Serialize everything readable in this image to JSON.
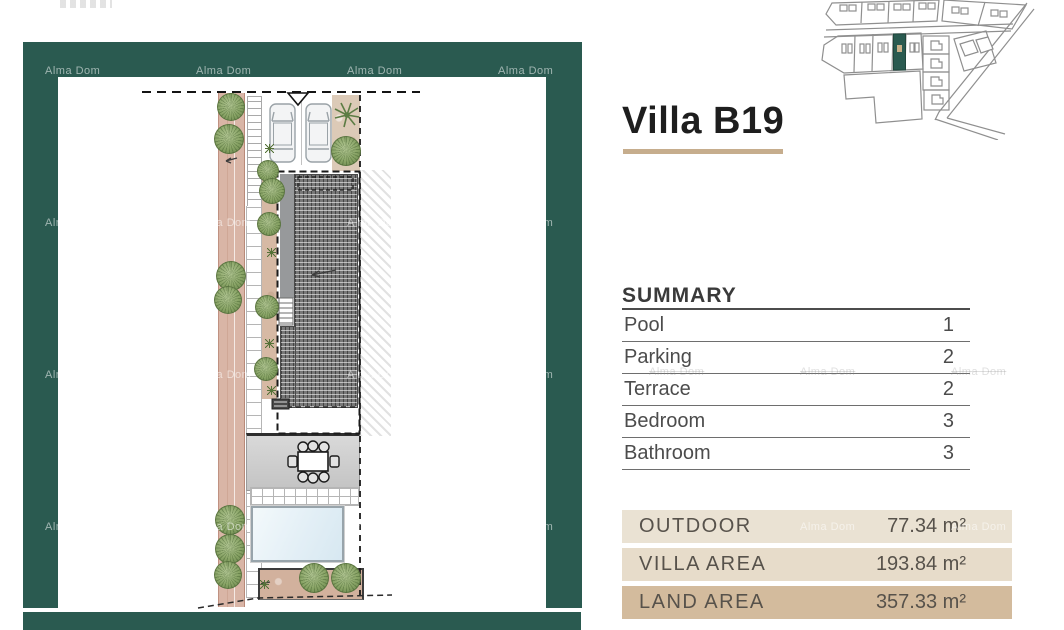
{
  "watermark_text": "Alma Dom",
  "panel": {
    "title": "Villa B19",
    "summary_heading": "SUMMARY",
    "summary_rows": [
      {
        "label": "Pool",
        "value": "1"
      },
      {
        "label": "Parking",
        "value": "2"
      },
      {
        "label": "Terrace",
        "value": "2"
      },
      {
        "label": "Bedroom",
        "value": "3"
      },
      {
        "label": "Bathroom",
        "value": "3"
      }
    ],
    "area_rows": [
      {
        "label": "OUTDOOR",
        "value": "77.34 m²",
        "tone": "light"
      },
      {
        "label": "VILLA AREA",
        "value": "193.84 m²",
        "tone": "mid"
      },
      {
        "label": "LAND AREA",
        "value": "357.33 m²",
        "tone": "dark"
      }
    ]
  },
  "colors": {
    "frame_green": "#2a5a50",
    "accent_tan": "#c6ad8d",
    "row_light": "#eae2d3",
    "row_mid": "#e7dcca",
    "row_dark": "#d3bb9d",
    "map_highlight": "#2a5a50",
    "map_highlight_dot": "#c9b089"
  }
}
